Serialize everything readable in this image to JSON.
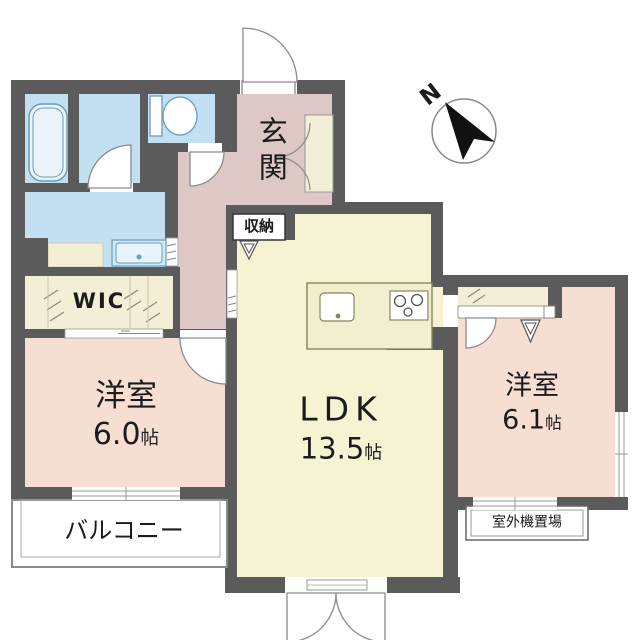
{
  "compass": {
    "north_label": "N"
  },
  "rooms": {
    "entrance": {
      "name": "玄関"
    },
    "storage": {
      "name": "収納"
    },
    "wic": {
      "name": "WIC"
    },
    "bedroom_left": {
      "name": "洋室",
      "area_value": "6.0",
      "area_unit": "帖"
    },
    "ldk": {
      "name": "LDK",
      "area_value": "13.5",
      "area_unit": "帖"
    },
    "bedroom_right": {
      "name": "洋室",
      "area_value": "6.1",
      "area_unit": "帖"
    },
    "balcony": {
      "name": "バルコニー"
    },
    "outdoor_unit": {
      "name": "室外機置場"
    }
  },
  "colors": {
    "wall": "#5b5b5b",
    "wet_area_floor": "#c3e0f2",
    "hall_floor": "#ddc8c5",
    "bedroom_floor": "#f7ded3",
    "ldk_floor": "#f5f3d2",
    "closet_floor": "#f3efd6",
    "fixture_stroke": "#6b9cbd",
    "compass_arrow": "#111111"
  }
}
